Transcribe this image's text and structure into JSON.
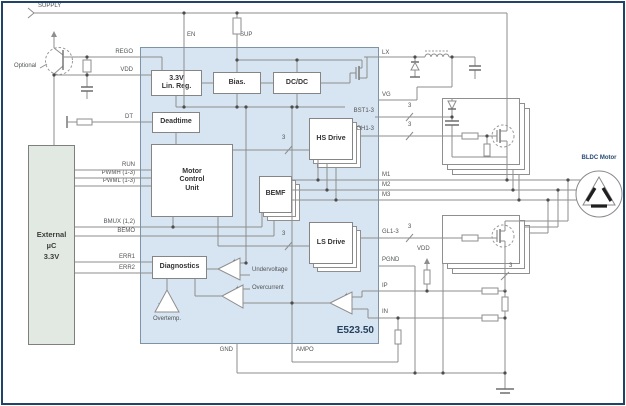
{
  "chip": {
    "part_number": "E523.50"
  },
  "labels": {
    "supply": "SUPPLY",
    "optional": "Optional",
    "bldc_motor": "BLDC Motor",
    "lu": "LU",
    "lv": "LV",
    "lw": "LW",
    "undervoltage": "Undervoltage",
    "overcurrent": "Overcurrent",
    "overtemp": "Overtemp.",
    "bus_width": "3",
    "plus": "+",
    "minus": "-"
  },
  "external_mcu": {
    "line1": "External",
    "line2": "µC",
    "line3": "3.3V"
  },
  "blocks": {
    "linreg_line1": "3.3V",
    "linreg_line2": "Lin. Reg.",
    "bias": "Bias.",
    "dcdc": "DC/DC",
    "deadtime": "Deadtime",
    "mcu_line1": "Motor",
    "mcu_line2": "Control",
    "mcu_line3": "Unit",
    "bemf": "BEMF",
    "hs_drive": "HS Drive",
    "ls_drive": "LS Drive",
    "diagnostics": "Diagnostics"
  },
  "pins": {
    "en": "EN",
    "sup": "SUP",
    "rego": "REGO",
    "vdd": "VDD",
    "dt": "DT",
    "run": "RUN",
    "pwmh": "PWMH (1-3)",
    "pwml": "PWML (1-3)",
    "bmux": "BMUX (1,2)",
    "bemo": "BEMO",
    "err1": "ERR1",
    "err2": "ERR2",
    "lx": "LX",
    "vg": "VG",
    "bst": "BST1-3",
    "gh": "GH1-3",
    "m1": "M1",
    "m2": "M2",
    "m3": "M3",
    "gl": "GL1-3",
    "pgnd": "PGND",
    "ip": "IP",
    "in": "IN",
    "gnd": "GND",
    "ampo": "AMPO"
  },
  "colors": {
    "ic_fill": "#d7e5f2",
    "mcu_fill": "#e2e9e2",
    "frame": "#1f4468",
    "wire": "#8e8e8e",
    "winding": "#1f1f1f",
    "navy_text": "#274a73"
  }
}
